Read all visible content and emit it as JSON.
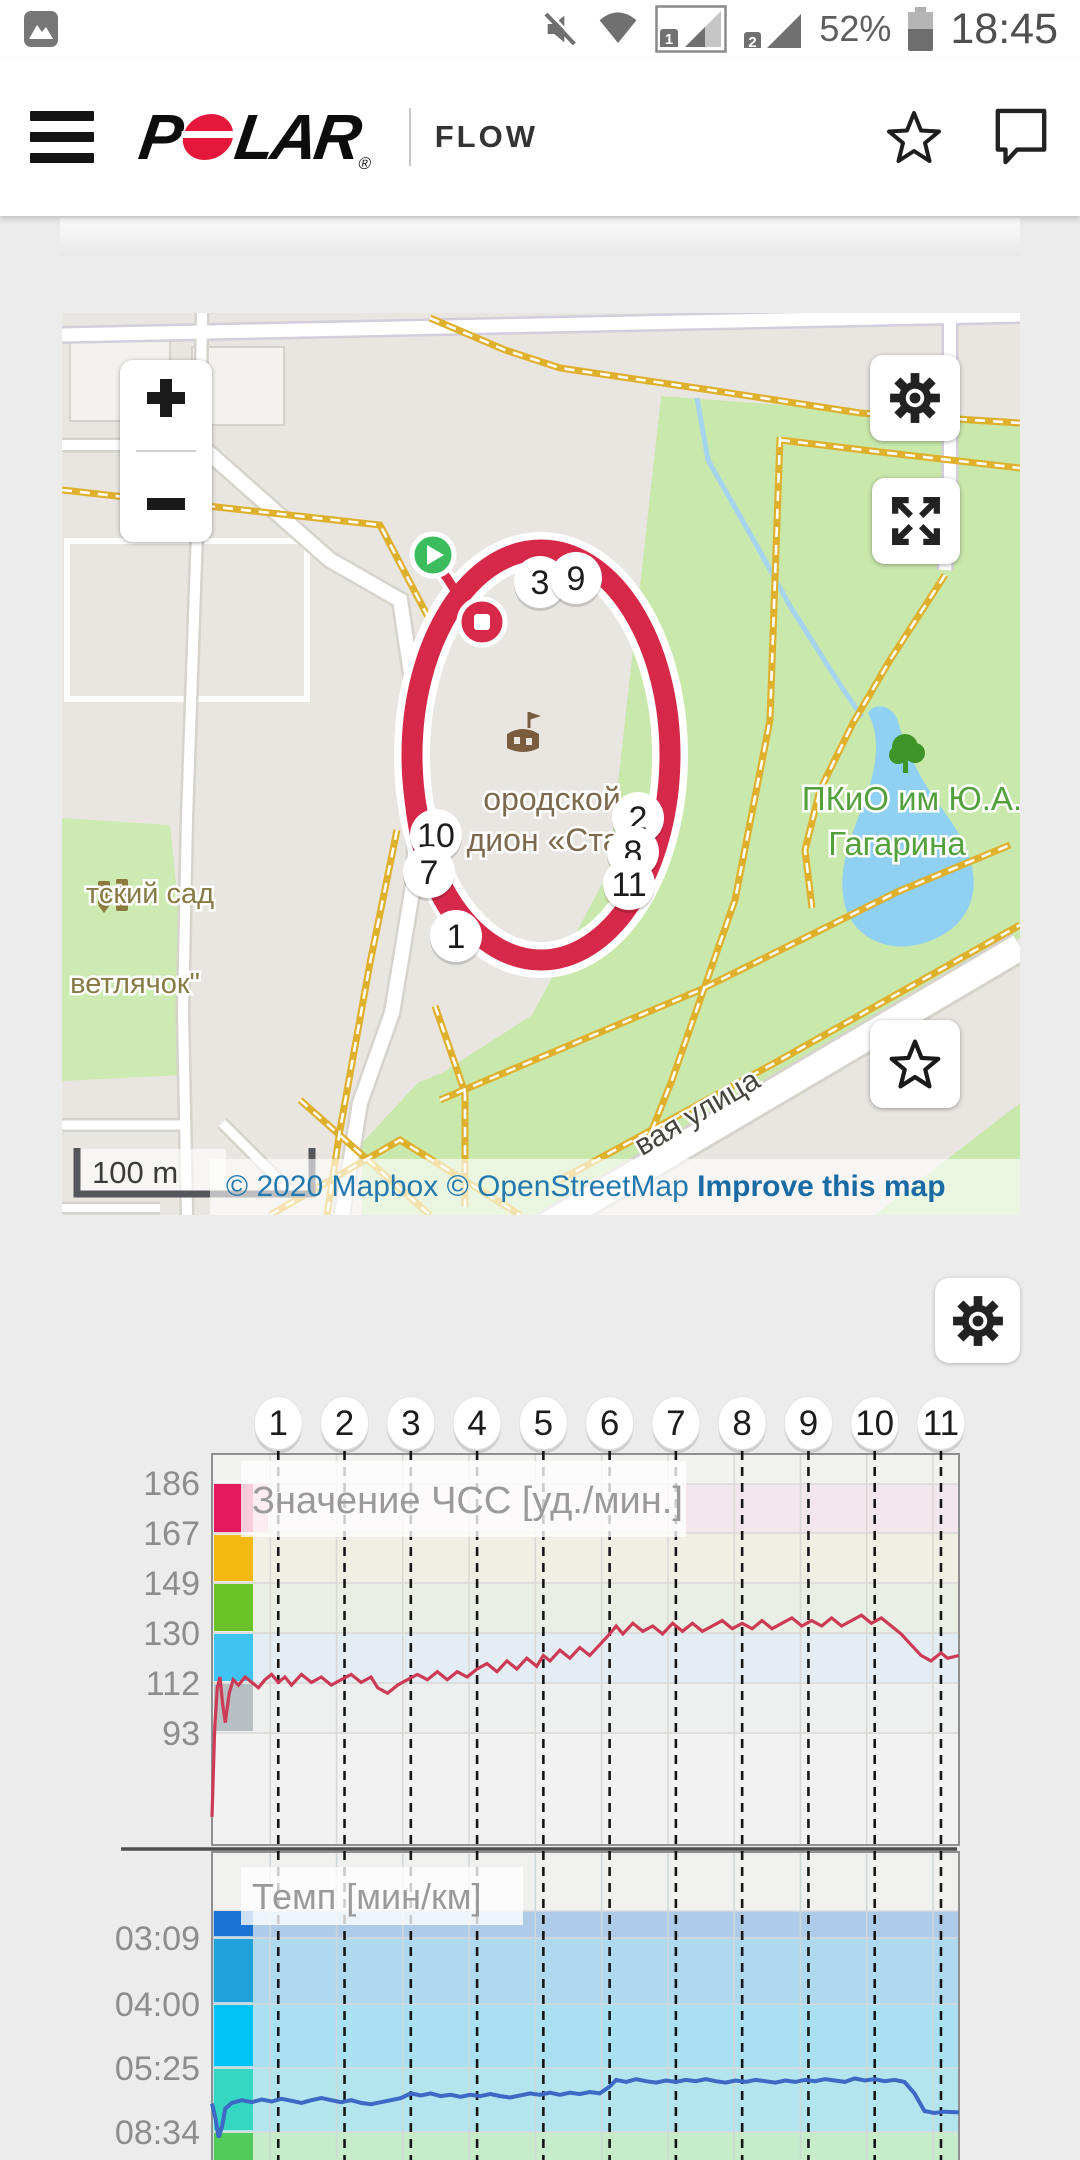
{
  "status_bar": {
    "time": "18:45",
    "battery": "52%",
    "sim1_label": "1",
    "sim2_label": "2"
  },
  "header": {
    "brand_p": "P",
    "brand_lar": "LAR",
    "registered": "®",
    "product": "FLOW"
  },
  "map": {
    "scale_label": "100 m",
    "attribution": "© 2020 Mapbox © OpenStreetMap ",
    "attribution_link": "Improve this map",
    "labels": {
      "stadium_1": "ородской",
      "stadium_2": "с дион «Стар",
      "park_1": "ПКиО им Ю.А.",
      "park_2": "Гагарина",
      "kindergarten_1": "тский сад",
      "kindergarten_2": "ветлячок\"",
      "street": "вая улица"
    },
    "route_markers": [
      {
        "label": "3",
        "x": 478,
        "y": 269
      },
      {
        "label": "9",
        "x": 514,
        "y": 265
      },
      {
        "label": "2",
        "x": 576,
        "y": 505
      },
      {
        "label": "8",
        "x": 571,
        "y": 539
      },
      {
        "label": "11",
        "x": 567,
        "y": 571
      },
      {
        "label": "10",
        "x": 374,
        "y": 522
      },
      {
        "label": "7",
        "x": 367,
        "y": 559
      },
      {
        "label": "1",
        "x": 394,
        "y": 623
      }
    ]
  },
  "charts": {
    "km_markers": [
      "1",
      "2",
      "3",
      "4",
      "5",
      "6",
      "7",
      "8",
      "9",
      "10",
      "11"
    ]
  },
  "chart_data": [
    {
      "type": "line",
      "title": "Значение ЧСС [уд./мин.]",
      "ylabel": "уд./мин.",
      "yticks": [
        "186",
        "167",
        "149",
        "130",
        "112",
        "93"
      ],
      "ytick_values": [
        186,
        167,
        149,
        130,
        112,
        93
      ],
      "zone_colors": [
        "#e5195e",
        "#f6b812",
        "#6cc327",
        "#3fc3f0",
        "#b7c0c3"
      ],
      "band_colors": [
        "#f2f2f1",
        "#f3e6ec",
        "#f0efe3",
        "#e9efe4",
        "#e4edf3",
        "#eef0ef",
        "#f1f2f1"
      ],
      "line_color": "#cc3a56",
      "x_unit": "km",
      "x_max": 11.27,
      "x_markers": [
        1,
        2,
        3,
        4,
        5,
        6,
        7,
        8,
        9,
        10,
        11
      ],
      "series": [
        {
          "name": "ЧСС",
          "points": [
            [
              0,
              62
            ],
            [
              0.04,
              95
            ],
            [
              0.08,
              110
            ],
            [
              0.12,
              114
            ],
            [
              0.16,
              104
            ],
            [
              0.2,
              97
            ],
            [
              0.26,
              108
            ],
            [
              0.32,
              113
            ],
            [
              0.4,
              111
            ],
            [
              0.5,
              114
            ],
            [
              0.6,
              112
            ],
            [
              0.7,
              110
            ],
            [
              0.8,
              113
            ],
            [
              0.9,
              115
            ],
            [
              1.0,
              112
            ],
            [
              1.1,
              114
            ],
            [
              1.2,
              111
            ],
            [
              1.35,
              115
            ],
            [
              1.5,
              112
            ],
            [
              1.65,
              114
            ],
            [
              1.8,
              111
            ],
            [
              1.95,
              113
            ],
            [
              2.1,
              115
            ],
            [
              2.25,
              112
            ],
            [
              2.4,
              114
            ],
            [
              2.5,
              110
            ],
            [
              2.65,
              108
            ],
            [
              2.8,
              111
            ],
            [
              2.95,
              113
            ],
            [
              3.1,
              115
            ],
            [
              3.25,
              113
            ],
            [
              3.4,
              116
            ],
            [
              3.55,
              113
            ],
            [
              3.7,
              116
            ],
            [
              3.85,
              114
            ],
            [
              4.0,
              117
            ],
            [
              4.15,
              119
            ],
            [
              4.3,
              116
            ],
            [
              4.45,
              120
            ],
            [
              4.6,
              117
            ],
            [
              4.75,
              121
            ],
            [
              4.9,
              118
            ],
            [
              5.0,
              122
            ],
            [
              5.1,
              120
            ],
            [
              5.25,
              124
            ],
            [
              5.4,
              121
            ],
            [
              5.55,
              125
            ],
            [
              5.7,
              122
            ],
            [
              5.85,
              126
            ],
            [
              6.0,
              130
            ],
            [
              6.1,
              133
            ],
            [
              6.2,
              130
            ],
            [
              6.35,
              134
            ],
            [
              6.5,
              131
            ],
            [
              6.65,
              133
            ],
            [
              6.8,
              130
            ],
            [
              6.95,
              134
            ],
            [
              7.1,
              131
            ],
            [
              7.25,
              134
            ],
            [
              7.4,
              131
            ],
            [
              7.55,
              133
            ],
            [
              7.7,
              135
            ],
            [
              7.85,
              132
            ],
            [
              8.0,
              134
            ],
            [
              8.15,
              132
            ],
            [
              8.3,
              135
            ],
            [
              8.45,
              132
            ],
            [
              8.6,
              134
            ],
            [
              8.75,
              136
            ],
            [
              8.9,
              133
            ],
            [
              9.05,
              135
            ],
            [
              9.2,
              133
            ],
            [
              9.35,
              136
            ],
            [
              9.5,
              133
            ],
            [
              9.65,
              135
            ],
            [
              9.8,
              137
            ],
            [
              9.95,
              134
            ],
            [
              10.1,
              136
            ],
            [
              10.25,
              133
            ],
            [
              10.4,
              130
            ],
            [
              10.55,
              126
            ],
            [
              10.7,
              122
            ],
            [
              10.85,
              120
            ],
            [
              11.0,
              123
            ],
            [
              11.1,
              121
            ],
            [
              11.27,
              122
            ]
          ]
        }
      ]
    },
    {
      "type": "line",
      "title": "Темп [мин/км]",
      "ylabel": "мин/км",
      "yticks": [
        "03:09",
        "04:00",
        "05:25",
        "08:34"
      ],
      "ytick_seconds": [
        189,
        240,
        325,
        514
      ],
      "zone_colors": [
        "#1b74d3",
        "#21a2db",
        "#02c3f5",
        "#35d6c2",
        "#53ca5c"
      ],
      "band_colors": [
        "#f0f0ef",
        "#aecbe9",
        "#aed9ee",
        "#a9e1f3",
        "#b2e5ee",
        "#c6ecca"
      ],
      "line_color": "#3d68c5",
      "x_unit": "km",
      "x_max": 11.27,
      "x_markers": [
        1,
        2,
        3,
        4,
        5,
        6,
        7,
        8,
        9,
        10,
        11
      ],
      "series": [
        {
          "name": "Темп",
          "points": [
            [
              0,
              430
            ],
            [
              0.05,
              470
            ],
            [
              0.1,
              530
            ],
            [
              0.15,
              500
            ],
            [
              0.2,
              445
            ],
            [
              0.3,
              428
            ],
            [
              0.45,
              420
            ],
            [
              0.6,
              426
            ],
            [
              0.75,
              418
            ],
            [
              0.9,
              424
            ],
            [
              1.05,
              416
            ],
            [
              1.2,
              422
            ],
            [
              1.35,
              428
            ],
            [
              1.5,
              420
            ],
            [
              1.65,
              414
            ],
            [
              1.8,
              420
            ],
            [
              1.95,
              426
            ],
            [
              2.1,
              420
            ],
            [
              2.25,
              428
            ],
            [
              2.4,
              432
            ],
            [
              2.55,
              426
            ],
            [
              2.7,
              420
            ],
            [
              2.85,
              414
            ],
            [
              3.0,
              400
            ],
            [
              3.15,
              406
            ],
            [
              3.3,
              400
            ],
            [
              3.45,
              408
            ],
            [
              3.6,
              404
            ],
            [
              3.75,
              410
            ],
            [
              3.9,
              404
            ],
            [
              4.05,
              408
            ],
            [
              4.2,
              402
            ],
            [
              4.35,
              408
            ],
            [
              4.5,
              412
            ],
            [
              4.65,
              406
            ],
            [
              4.8,
              400
            ],
            [
              4.95,
              404
            ],
            [
              5.1,
              398
            ],
            [
              5.25,
              404
            ],
            [
              5.4,
              398
            ],
            [
              5.55,
              402
            ],
            [
              5.7,
              396
            ],
            [
              5.85,
              400
            ],
            [
              6.0,
              380
            ],
            [
              6.1,
              360
            ],
            [
              6.25,
              366
            ],
            [
              6.4,
              358
            ],
            [
              6.55,
              364
            ],
            [
              6.7,
              368
            ],
            [
              6.85,
              362
            ],
            [
              7.0,
              366
            ],
            [
              7.15,
              360
            ],
            [
              7.3,
              364
            ],
            [
              7.45,
              358
            ],
            [
              7.6,
              364
            ],
            [
              7.75,
              368
            ],
            [
              7.9,
              362
            ],
            [
              8.05,
              366
            ],
            [
              8.2,
              360
            ],
            [
              8.35,
              364
            ],
            [
              8.5,
              368
            ],
            [
              8.65,
              362
            ],
            [
              8.8,
              366
            ],
            [
              8.95,
              360
            ],
            [
              9.1,
              364
            ],
            [
              9.25,
              358
            ],
            [
              9.4,
              362
            ],
            [
              9.55,
              366
            ],
            [
              9.7,
              356
            ],
            [
              9.85,
              362
            ],
            [
              10.0,
              358
            ],
            [
              10.15,
              364
            ],
            [
              10.3,
              360
            ],
            [
              10.45,
              366
            ],
            [
              10.6,
              400
            ],
            [
              10.75,
              452
            ],
            [
              10.9,
              458
            ],
            [
              11.05,
              454
            ],
            [
              11.27,
              456
            ]
          ]
        }
      ]
    }
  ]
}
